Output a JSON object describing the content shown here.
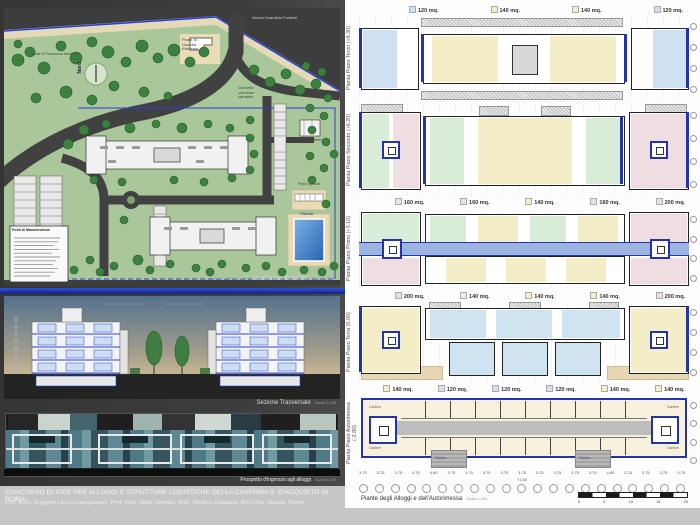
{
  "board": {
    "title": "CONCORSO DI IDEE PER ALLOGGI E STRUTTURE LOGISTICHE DELLA CASERMA S. D'ACQUISTO IN ROMA",
    "authors": "Prof. Arch. Ruggero Lenci (capogruppo), Prof. Arch. Nilda Valentin, Arch. Stefano Catalano, Arch./Ing. Claudio Merler"
  },
  "site_plan": {
    "caption": "Planimetria d'insieme",
    "caption_scale": "Scala 1:500",
    "labels": {
      "nuova_guardiola": "Nuova Guardiola Portiere",
      "sosta_marshall": "Sosta di Tommaso Marshall",
      "nord": "Nord",
      "posto_guardia": "Posto di Guardia Esistente",
      "cancello": "Cancello veicolare carrabile",
      "alloggio_portiere": "Alloggio Portiere",
      "parco_giochi": "Parco giochi",
      "piscina": "Piscina",
      "legend_title": "Posti di Manutenzione"
    }
  },
  "section": {
    "caption": "Sezione Trasversale",
    "caption_scale": "Scala 1:200"
  },
  "render": {
    "caption": "Prospetto d'ingresso agli alloggi",
    "caption_scale": "Scala 1:100"
  },
  "plans": {
    "caption": "Piante degli Alloggi e dell'Autorimessa",
    "caption_scale": "Scala 1:200",
    "rows": [
      {
        "side_label": "Pianta Piano Terzo (+9.30)"
      },
      {
        "side_label": "Pianta Piano Secondo (+6.20)"
      },
      {
        "side_label": "Pianta Piano Primo (+3.10)"
      },
      {
        "side_label": "Pianta Piano Terra (0.00)"
      },
      {
        "side_label": "Pianta Piano Autorimessa (-2.80)"
      }
    ],
    "label_rows": [
      {
        "items": [
          "120 mq.",
          "140 mq.",
          "140 mq.",
          "120 mq."
        ]
      },
      {
        "items": [
          "160 mq.",
          "160 mq.",
          "140 mq.",
          "160 mq.",
          "200 mq."
        ]
      },
      {
        "items": [
          "200 mq.",
          "140 mq.",
          "140 mq.",
          "140 mq.",
          "200 mq."
        ]
      },
      {
        "items": [
          "140 mq.",
          "120 mq.",
          "120 mq.",
          "120 mq.",
          "140 mq.",
          "140 mq."
        ]
      }
    ],
    "garage": {
      "corner_label": "Cantine",
      "ramp_label": "Rampa"
    },
    "dimension_line": "3.75 3.75 3.75 3.75 4.80 3.75 3.75 3.75 3.75 3.75 3.75 3.75 3.75 3.75 4.80 3.75 3.75 3.75 3.75",
    "dimension_total": "71.50",
    "scalebar_labels": [
      "0",
      "5",
      "10",
      "15",
      "20"
    ]
  },
  "colors": {
    "unit_120": "#cfe0f0",
    "unit_140": "#f5efc9",
    "unit_160": "#d8ecd8",
    "unit_200": "#f0dde2",
    "accent_blue": "#2433a8",
    "walkway_blue": "#9db4e0",
    "site_green": "#a9c79b",
    "road_gray": "#414141",
    "tree_green": "#3c8140",
    "pool_blue": "#2a62b0",
    "sand_beige": "#e7d7b5",
    "sky_blue": "#54718e",
    "glass_teal": "#55808d",
    "board_dark": "#3b3b3b",
    "board_gray": "#c6c6c6"
  }
}
